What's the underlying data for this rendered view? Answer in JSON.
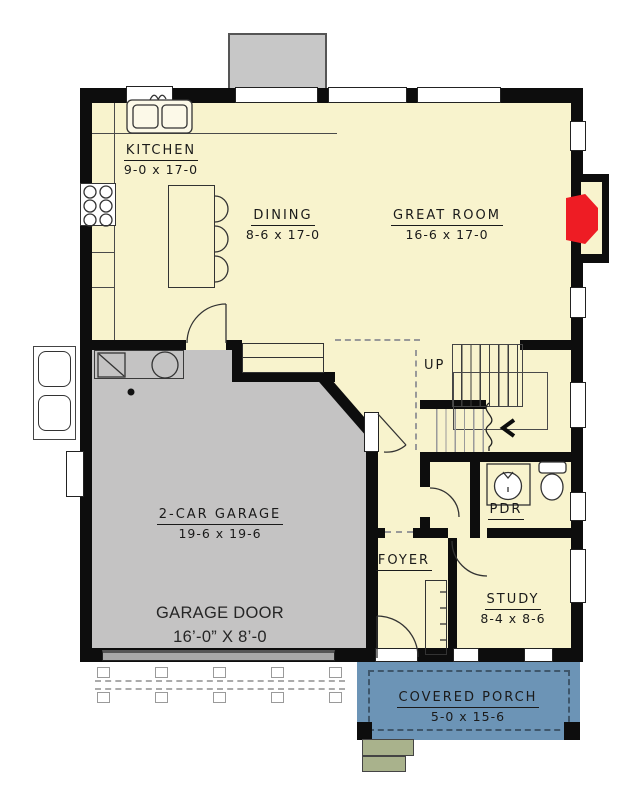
{
  "floor_plan": {
    "rooms": {
      "kitchen": {
        "name": "KITCHEN",
        "dims": "9-0 x 17-0"
      },
      "dining": {
        "name": "DINING",
        "dims": "8-6 x 17-0"
      },
      "great_room": {
        "name": "GREAT ROOM",
        "dims": "16-6 x 17-0"
      },
      "garage": {
        "name": "2-CAR GARAGE",
        "dims": "19-6 x 19-6"
      },
      "foyer": {
        "name": "FOYER"
      },
      "study": {
        "name": "STUDY",
        "dims": "8-4 x 8-6"
      },
      "powder_room": {
        "name": "PDR"
      },
      "covered_porch": {
        "name": "COVERED PORCH",
        "dims": "5-0 x 15-6"
      }
    },
    "garage_door": {
      "name": "GARAGE DOOR",
      "dims": "16’-0” X 8’-0"
    },
    "stairs": {
      "direction_label": "UP"
    },
    "colors": {
      "floor": "#F8F3CD",
      "garage": "#C4C3C3",
      "garage_door_panel": "#A8A8A8",
      "porch": "#6C94B6",
      "steps": "#A9B28C",
      "fireplace": "#EE1C24",
      "wall": "#0D0D0D",
      "exterior_box": "#C7C7C7"
    }
  }
}
